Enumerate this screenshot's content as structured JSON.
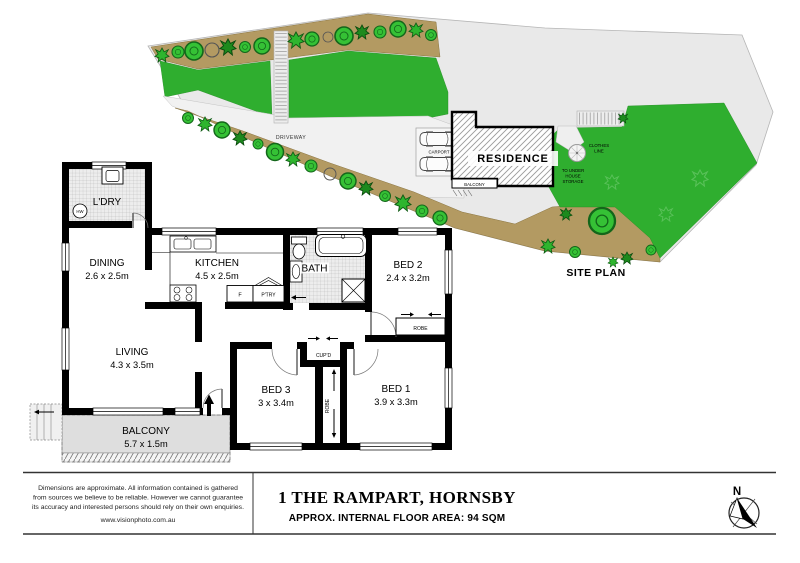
{
  "site": {
    "title": "SITE PLAN",
    "residence": "RESIDENCE",
    "carport": "CARPORT",
    "balcony": "BALCONY",
    "driveway": "DRIVEWAY",
    "clothes_line": [
      "CLOTHES",
      "LINE"
    ],
    "storage": [
      "TO UNDER",
      "HOUSE",
      "STORAGE"
    ]
  },
  "plan": {
    "laundry": "L'DRY",
    "hot_water": "HW",
    "dining": "DINING",
    "dining_dims": "2.6 x 2.5m",
    "kitchen": "KITCHEN",
    "kitchen_dims": "4.5 x 2.5m",
    "fridge": "F",
    "pantry": "P'TRY",
    "bath": "BATH",
    "bed2": "BED 2",
    "bed2_dims": "2.4 x 3.2m",
    "living": "LIVING",
    "living_dims": "4.3 x 3.5m",
    "bed3": "BED 3",
    "bed3_dims": "3 x 3.4m",
    "bed1": "BED 1",
    "bed1_dims": "3.9 x 3.3m",
    "balcony": "BALCONY",
    "balcony_dims": "5.7 x 1.5m",
    "robe_bed2": "ROBE",
    "robe_hall": "ROBE",
    "cupboard": "CUP'D"
  },
  "footer": {
    "disclaimer": [
      "Dimensions are approximate. All information contained is gathered",
      "from sources we believe to be reliable. However we cannot guarantee",
      "its accuracy and interested persons should rely on their own enquiries."
    ],
    "website": "www.visionphoto.com.au",
    "address": "1 THE RAMPART, HORNSBY",
    "area": "APPROX. INTERNAL FLOOR AREA: 94 SQM",
    "compass_n": "N"
  },
  "colors": {
    "lawn": "#2fae2f",
    "garden_bed": "#b39a62",
    "tree": "#35c135",
    "tree_outline": "#13661a",
    "lot": "#e9e9e9",
    "wall": "#000000",
    "balcony_fill": "#dedede"
  }
}
